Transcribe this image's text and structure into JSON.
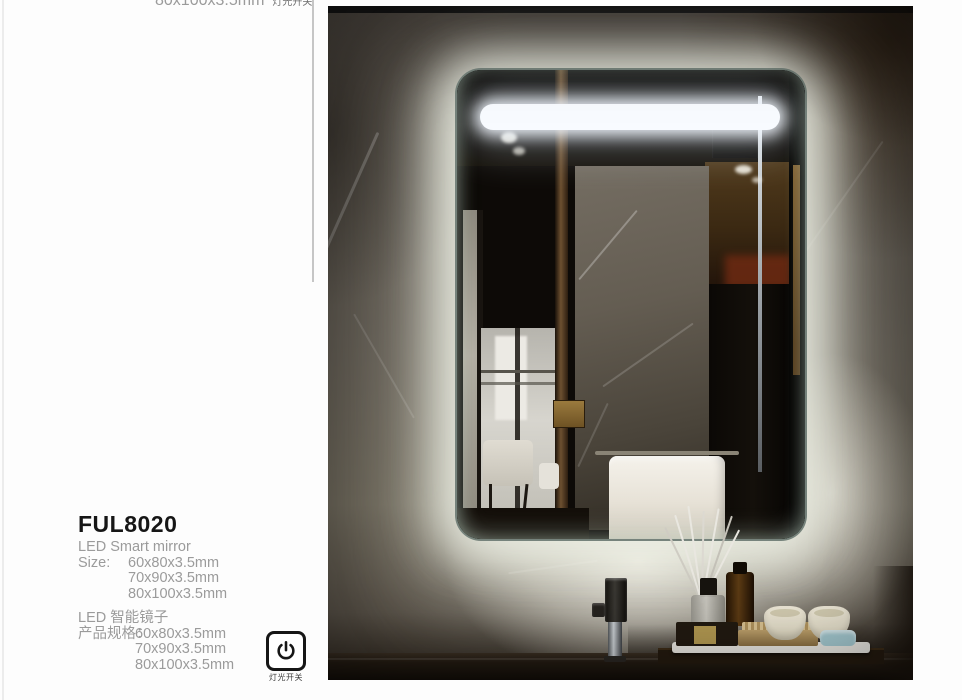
{
  "previous_card": {
    "clipped_size_line": "80x100x3.5mm",
    "clipped_switch_label": "灯光开关"
  },
  "product_card": {
    "model": "FUL8020",
    "title_en": "LED Smart mirror",
    "size_label_en": "Size:",
    "sizes_en": [
      "60x80x3.5mm",
      "70x90x3.5mm",
      "80x100x3.5mm"
    ],
    "title_zh": "LED 智能镜子",
    "size_label_zh": "产品规格：",
    "sizes_zh": [
      "60x80x3.5mm",
      "70x90x3.5mm",
      "80x100x3.5mm"
    ],
    "power_switch_label": "灯光开关"
  },
  "photo": {
    "colors": {
      "led_glow": "#eef0e6",
      "light_bar": "#f8fbff",
      "marble_wall": "#6b655b",
      "counter": "#1c150e",
      "towel": "#f2efe8",
      "candle": "#ebe6d3"
    }
  }
}
